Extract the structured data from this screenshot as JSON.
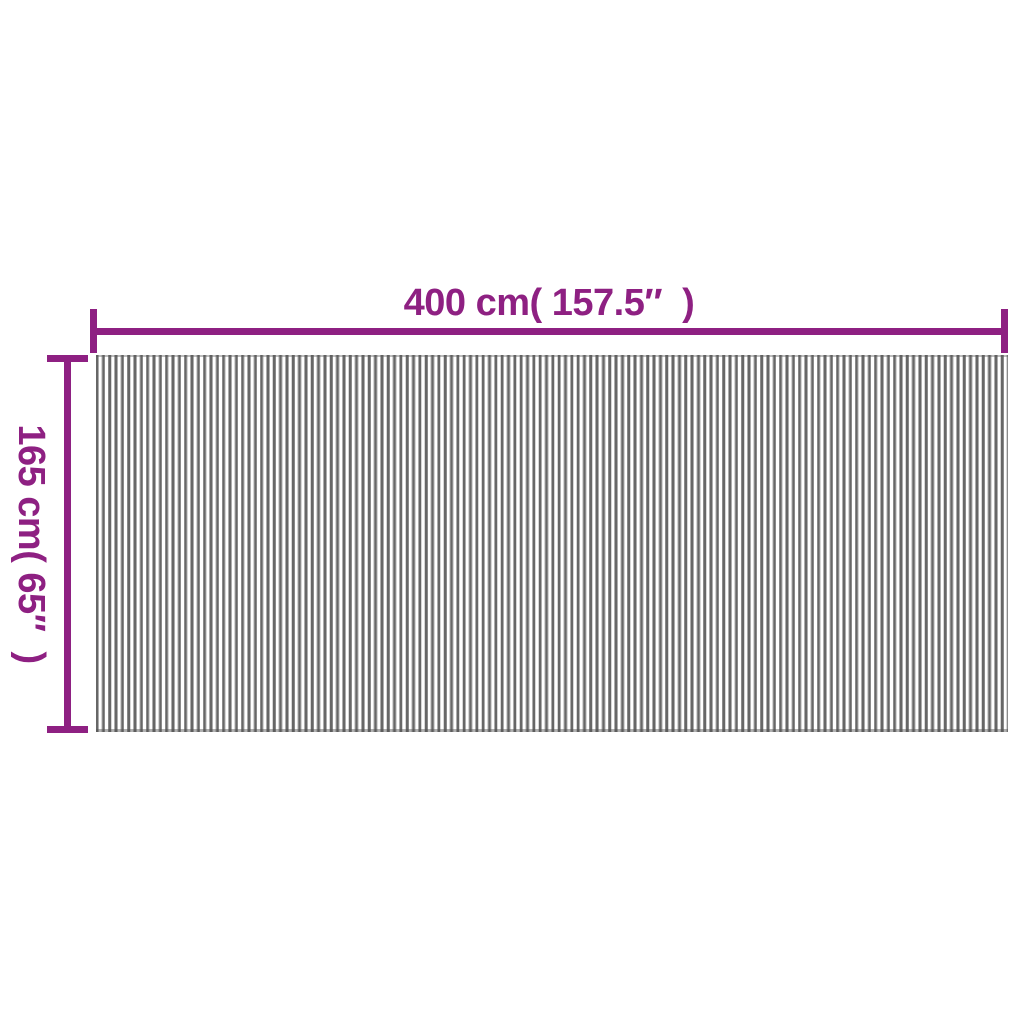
{
  "diagram": {
    "type": "product-dimension-diagram",
    "width_dimension": {
      "label": "400 cm( 157.5″  )"
    },
    "height_dimension": {
      "label": "165 cm( 65″  )"
    },
    "colors": {
      "accent": "#8e2082",
      "stripe_dark": "#676767",
      "stripe_mid": "#adadad",
      "stripe_white": "#ffffff",
      "bg": "#ffffff"
    }
  }
}
